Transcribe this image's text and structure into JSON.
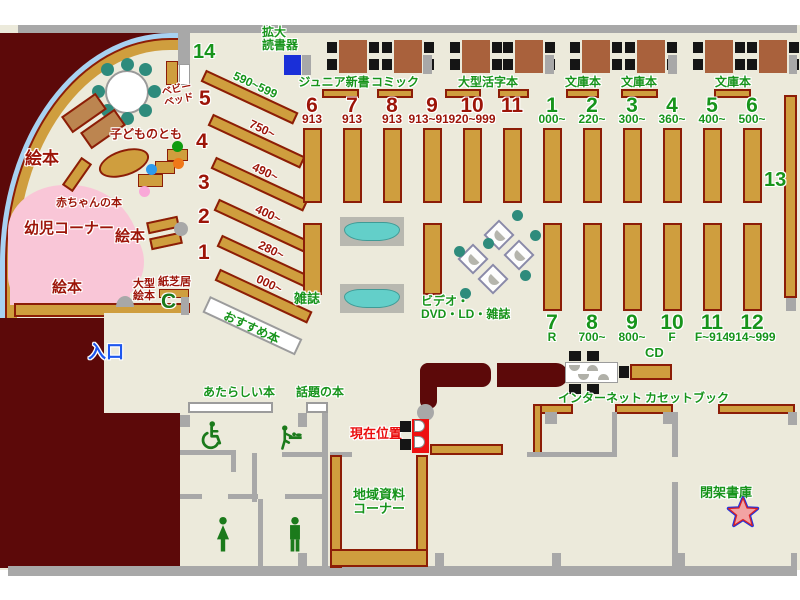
{
  "colors": {
    "floor": "#eceadb",
    "maroon": "#5c0909",
    "shelf_tan": "#cf9e3e",
    "shelf_border": "#8c1d07",
    "table_brown": "#a9613c",
    "wall_gray": "#a8a8a8",
    "green_text": "#17941b",
    "dark_red_text": "#9c1408",
    "red_text": "#ea0d0d",
    "blue_text": "#1d56ee",
    "pink_area": "#f9c6d7",
    "light_blue_band": "#a8d2f2",
    "teal_chair": "#2e8b7c",
    "bench_teal": "#63cfc9",
    "reader_blue": "#1a2fd8"
  },
  "children": {
    "ehon_left": "絵本",
    "ehon_mid": "絵本",
    "ehon_bottom": "絵本",
    "yoji_corner": "幼児コーナー",
    "akachan": "赤ちゃんの本",
    "kodomo": "子どものとも",
    "baby_bed_line1": "ベビー",
    "baby_bed_line2": "ベッド",
    "ogata_line1": "大型",
    "ogata_line2": "絵本",
    "kamishibai": "紙芝居",
    "phone_glyph": "C"
  },
  "left_stacks": [
    {
      "num": "14",
      "range": "590~599"
    },
    {
      "num": "5",
      "range": "750~"
    },
    {
      "num": "4",
      "range": "490~"
    },
    {
      "num": "3",
      "range": "400~"
    },
    {
      "num": "2",
      "range": "280~"
    },
    {
      "num": "1",
      "range": "000~"
    }
  ],
  "osusume": "おすすめ本",
  "top": {
    "kakudai_line1": "拡大",
    "kakudai_line2": "読書器",
    "junior": "ジュニア新書",
    "comic": "コミック",
    "ogata_katsuji": "大型活字本",
    "bunko1": "文庫本",
    "bunko2": "文庫本",
    "bunko3": "文庫本"
  },
  "center_cols": [
    {
      "num": "6",
      "sub": "913"
    },
    {
      "num": "7",
      "sub": "913"
    },
    {
      "num": "8",
      "sub": "913"
    },
    {
      "num": "9",
      "sub": "913~919"
    },
    {
      "num": "10",
      "sub": "920~999"
    },
    {
      "num": "11",
      "sub": ""
    }
  ],
  "right_cols_top": [
    {
      "num": "1",
      "sub": "000~"
    },
    {
      "num": "2",
      "sub": "220~"
    },
    {
      "num": "3",
      "sub": "300~"
    },
    {
      "num": "4",
      "sub": "360~"
    },
    {
      "num": "5",
      "sub": "400~"
    },
    {
      "num": "6",
      "sub": "500~"
    }
  ],
  "right_cols_bottom": [
    {
      "num": "7",
      "sub": "R"
    },
    {
      "num": "8",
      "sub": "700~"
    },
    {
      "num": "9",
      "sub": "800~"
    },
    {
      "num": "10",
      "sub": "F"
    },
    {
      "num": "11",
      "sub": "F~914"
    },
    {
      "num": "12",
      "sub": "914~999"
    }
  ],
  "shelf13_label": "13",
  "zasshi": "雑誌",
  "video_line1": "ビデオ・",
  "video_line2": "DVD・LD・雑誌",
  "entrance": "入口",
  "atarashii": "あたらしい本",
  "wadai": "話題の本",
  "genzai": "現在位置",
  "chiiki_line1": "地域資料",
  "chiiki_line2": "コーナー",
  "internet": "インターネット",
  "cd": "CD",
  "cassette": "カセットブック",
  "heika": "閉架書庫"
}
